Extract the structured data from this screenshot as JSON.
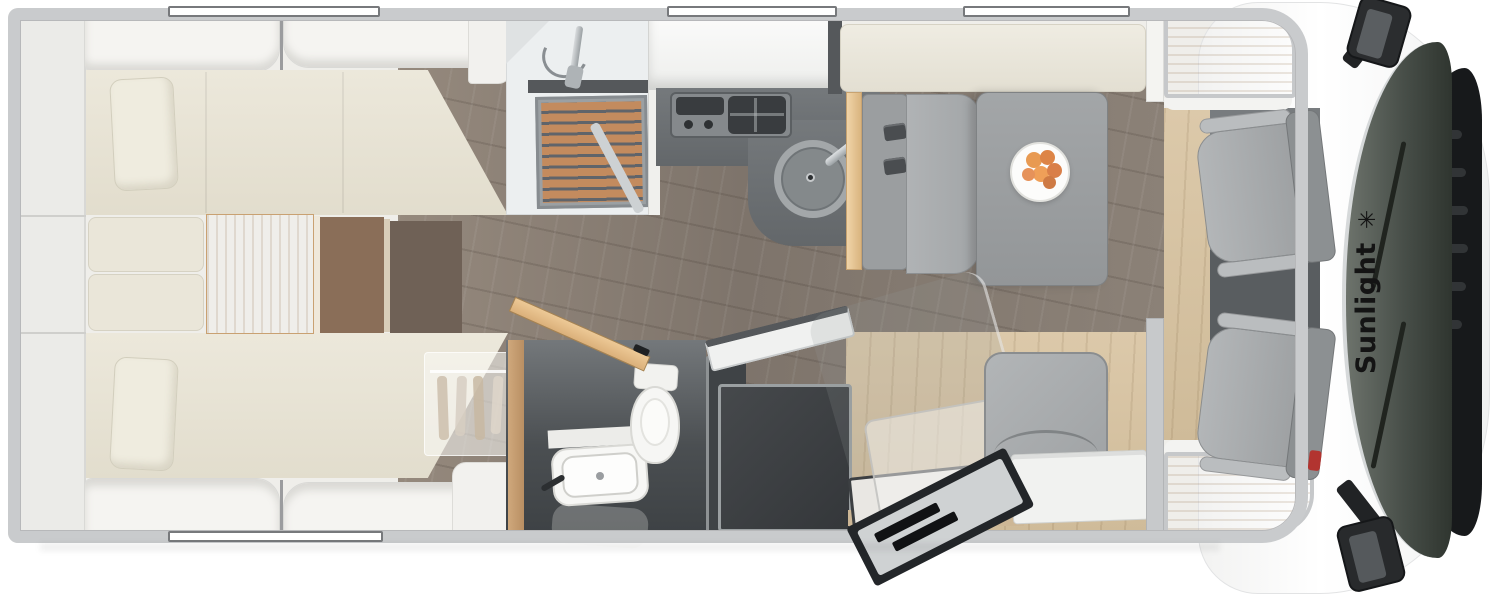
{
  "vehicle": {
    "brand": "Sunlight",
    "logo_mark": "✳",
    "type_label": "motorhome-floorplan-top-view"
  },
  "palette": {
    "body_white": "#ffffff",
    "wall_gray": "#c9cbcd",
    "interior_ivory": "#efeeea",
    "mattress_cream": "#e9e5d8",
    "floor_wood_dark": "#857a70",
    "floor_wood_light": "#d7c4a4",
    "counter_dark_gray": "#6b6f72",
    "bathroom_charcoal": "#3f4346",
    "shower_teak": "#c38b5e",
    "cushion_gray": "#a6a9ab",
    "accent_wood": "#e2bd8c",
    "windshield_green_gray": "#474e48",
    "logo_black": "#141414",
    "fruit_orange": "#e59a55"
  },
  "regions": {
    "rear": "twin-single-beds-with-center-steps",
    "mid_top": "shower-and-kitchen-with-hob-and-sink",
    "mid_bottom": "washroom-toilet-basin-and-fridge",
    "front_mid": "dinette-bench-table-with-fruit-plate",
    "front": "cab-with-two-swivel-seats"
  }
}
